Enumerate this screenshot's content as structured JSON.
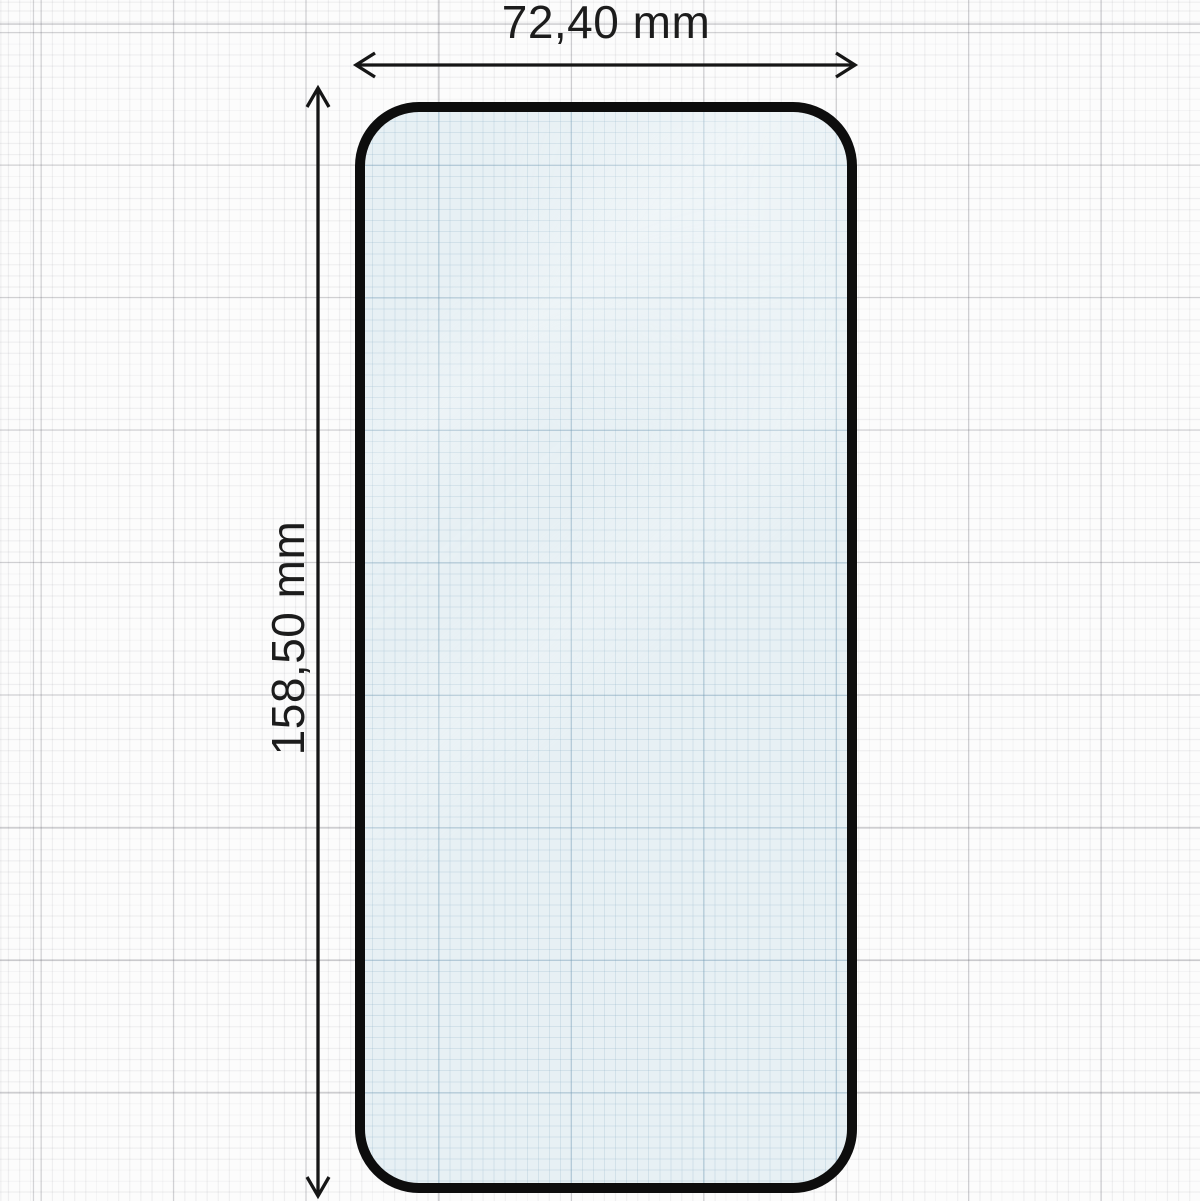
{
  "page": {
    "title": "Tempered glass screen protector — dimension diagram"
  },
  "dimensions": {
    "width": {
      "label": "72,40 mm",
      "orientation": "horizontal"
    },
    "height": {
      "label": "158,50 mm",
      "orientation": "vertical"
    }
  },
  "units": "mm",
  "colors": {
    "paper": "#fcfcfc",
    "grid_minor": "#ededed",
    "grid_major": "#d5d5d8",
    "glass_tint": "#e7f0f4",
    "glass_grid": "#b9d3df",
    "protector_border": "#0d0d0d",
    "dimension_line": "#161616",
    "label_text": "#1c1c1c"
  }
}
